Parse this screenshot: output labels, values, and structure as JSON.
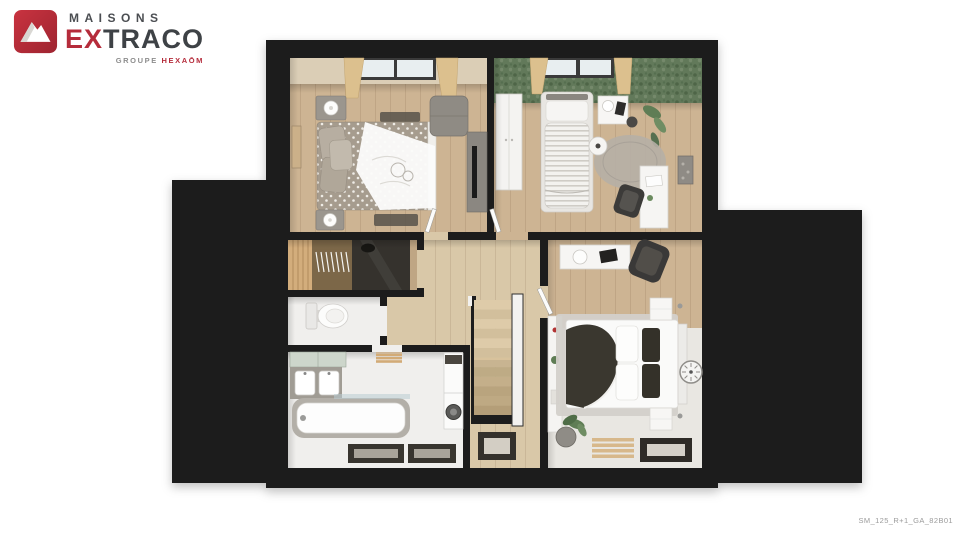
{
  "brand": {
    "logo_icon": "mountain-icon",
    "name_line1": "MAISONS",
    "name_line2_accent": "EX",
    "name_line2_rest": "TRACO",
    "tagline_muted": "GROUPE",
    "tagline_accent": "HEXAŌM"
  },
  "plan": {
    "reference_code": "SM_125_R+1_GA_82B01"
  },
  "palette": {
    "brand_red": "#b52c3b",
    "brand_dark": "#3e4246",
    "tagline_gray": "#8d8d8d",
    "roof_black": "#1c1c1c",
    "floor_wood": "#cdb493",
    "floor_wood_light": "#d9c8a8",
    "floor_light": "#e9e7e2",
    "wall_white": "#f6f6f4",
    "green_wall": "#62795a",
    "code_gray": "#9b9b9b"
  }
}
